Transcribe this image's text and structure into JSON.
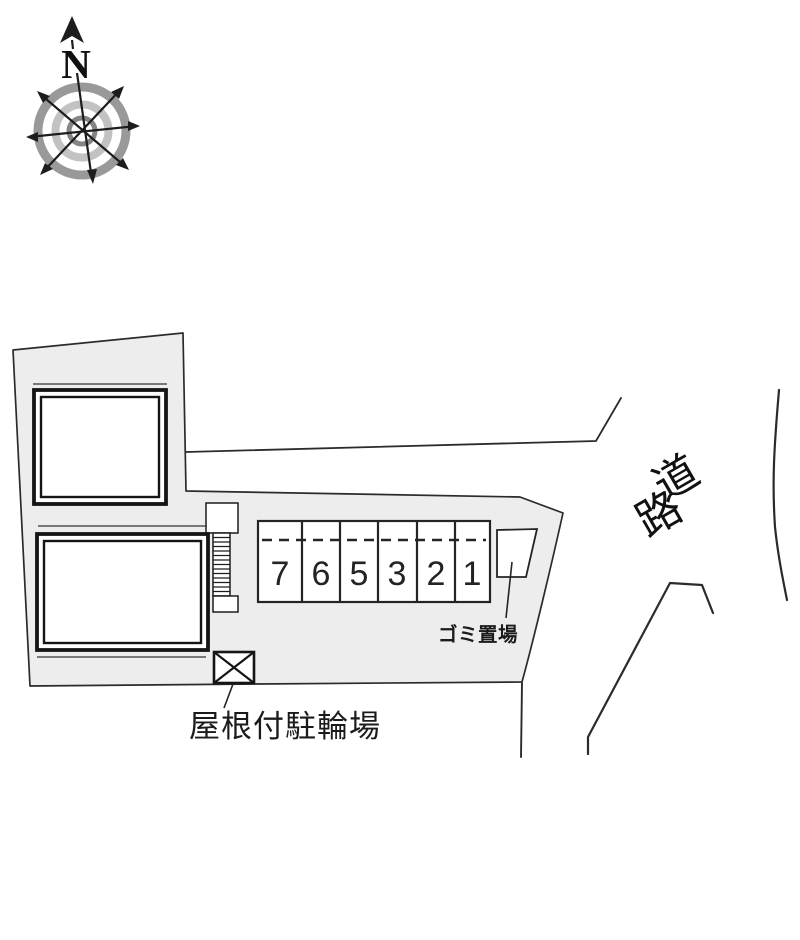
{
  "compass": {
    "north_label": "N"
  },
  "road_label": {
    "char_1": "道",
    "char_2": "路"
  },
  "parking": {
    "stalls": [
      "7",
      "6",
      "5",
      "3",
      "2",
      "1"
    ]
  },
  "annotations": {
    "garbage_area": "ゴミ置場",
    "covered_bicycle_parking": "屋根付駐輪場"
  },
  "colors": {
    "parcel_fill": "#ededed",
    "line": "#1f1f1f",
    "building_fill": "#ffffff",
    "compass_ring_outer": "#999999",
    "compass_ring_middle": "#c2c2c2",
    "compass_ring_inner": "#858585"
  }
}
